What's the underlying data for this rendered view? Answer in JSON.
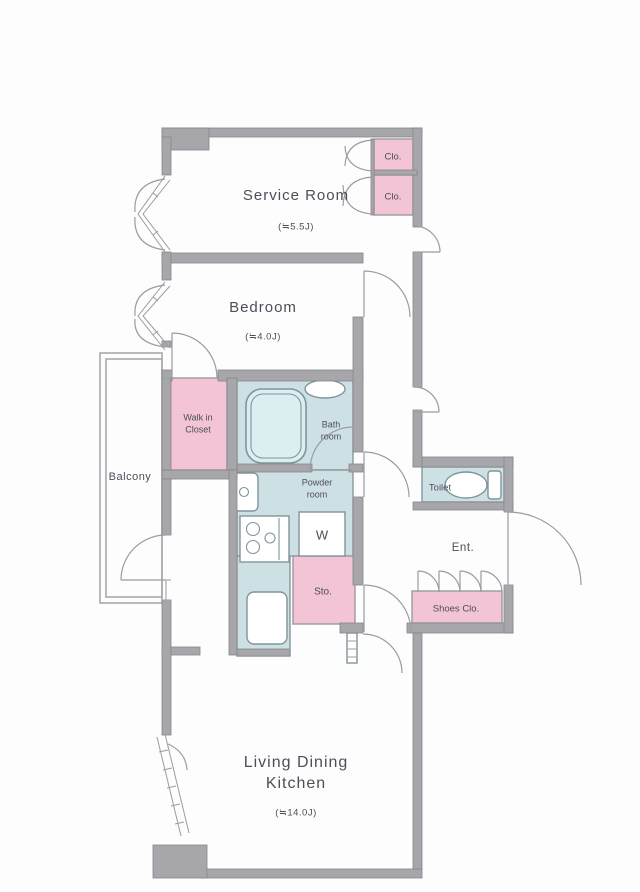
{
  "title": "Apartment floor plan",
  "colors": {
    "wall": "#a7a7ab",
    "wall_line": "#85858b",
    "pink": "#f2c4d5",
    "blue": "#cde1e4",
    "text": "#4e4e59"
  },
  "rooms": {
    "service_room": {
      "label": "Service Room",
      "size": "(≒5.5J)"
    },
    "bedroom": {
      "label": "Bedroom",
      "size": "(≒4.0J)"
    },
    "ldk": {
      "label_line1": "Living Dining",
      "label_line2": "Kitchen",
      "size": "(≒14.0J)"
    },
    "balcony": {
      "label": "Balcony"
    },
    "walk_in_closet": {
      "label_line1": "Walk in",
      "label_line2": "Closet"
    },
    "bath": {
      "label_line1": "Bath",
      "label_line2": "room"
    },
    "powder": {
      "label_line1": "Powder",
      "label_line2": "room"
    },
    "toilet": {
      "label": "Toilet"
    },
    "entrance": {
      "label": "Ent."
    },
    "storage": {
      "label": "Sto."
    },
    "washer": {
      "label": "W"
    },
    "closet_top": {
      "label": "Clo."
    },
    "closet_bottom": {
      "label": "Clo."
    },
    "shoes_closet": {
      "label": "Shoes Clo."
    }
  }
}
